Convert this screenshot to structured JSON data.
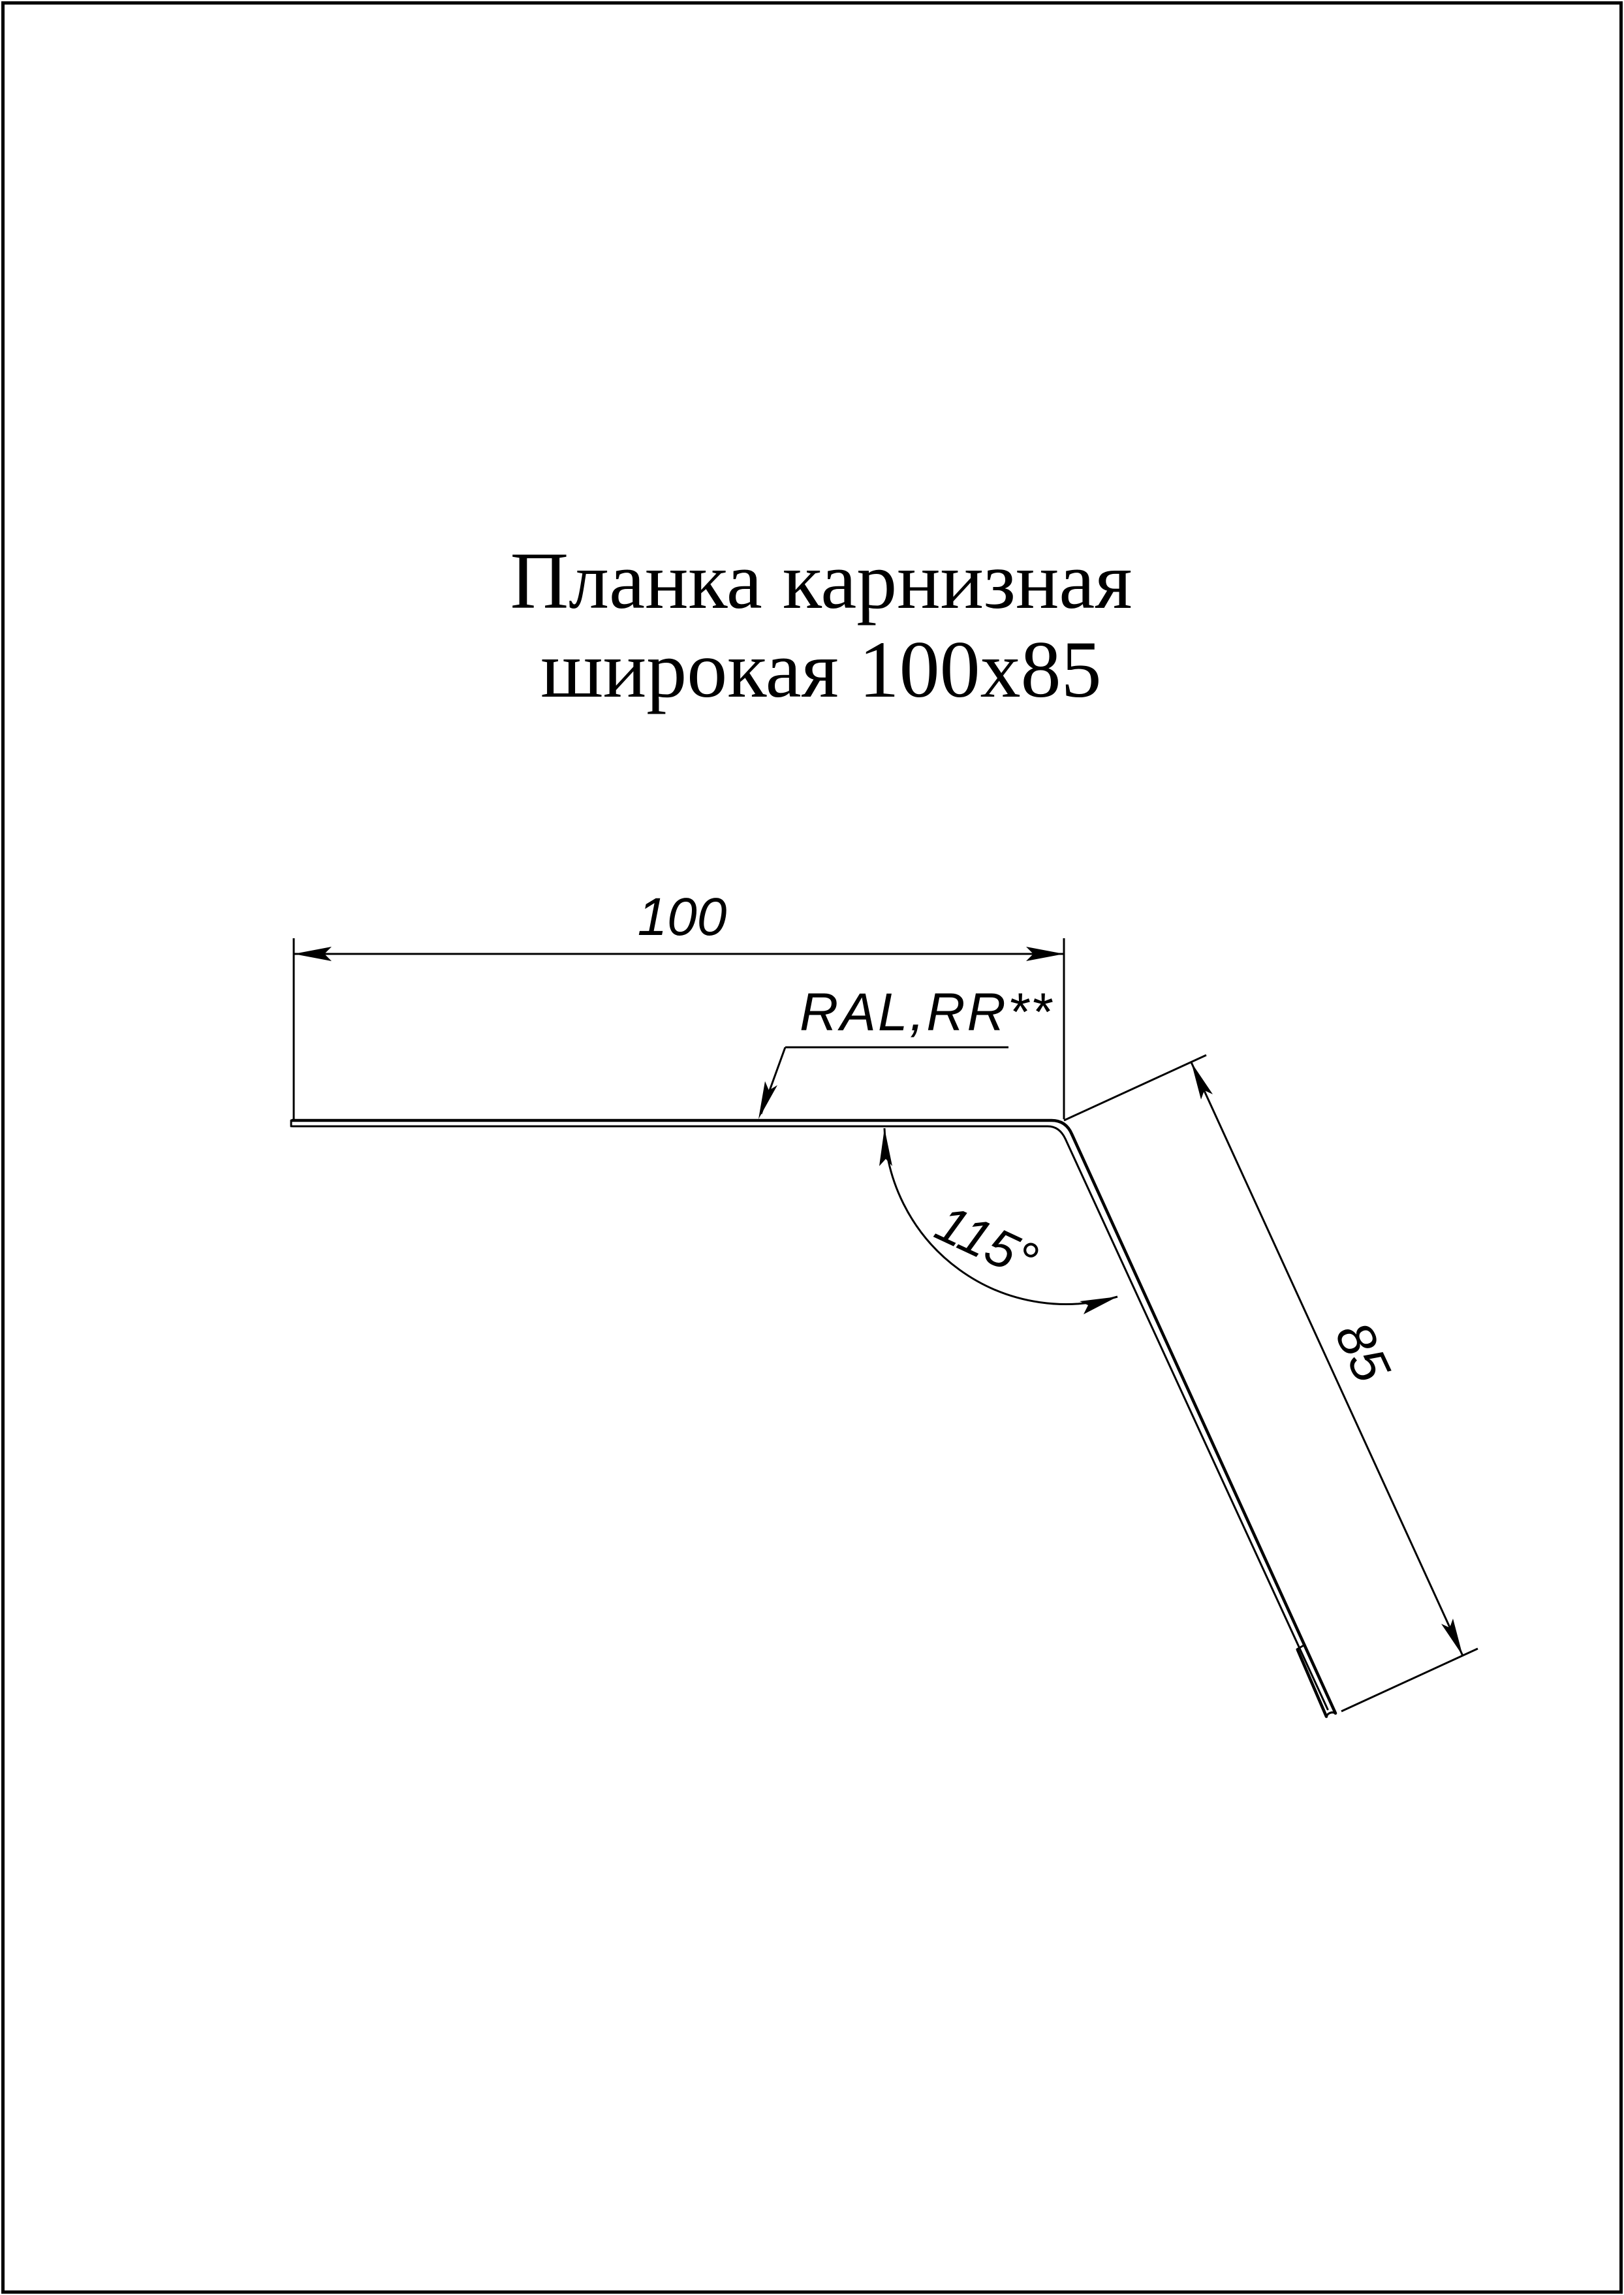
{
  "title": {
    "line1": "Планка карнизная",
    "line2": "широкая 100x85"
  },
  "drawing": {
    "width_dim": "100",
    "length_dim": "85",
    "angle_dim": "115°",
    "coating_label": "RAL,RR**"
  },
  "colors": {
    "ink": "#000000",
    "paper": "#ffffff"
  }
}
